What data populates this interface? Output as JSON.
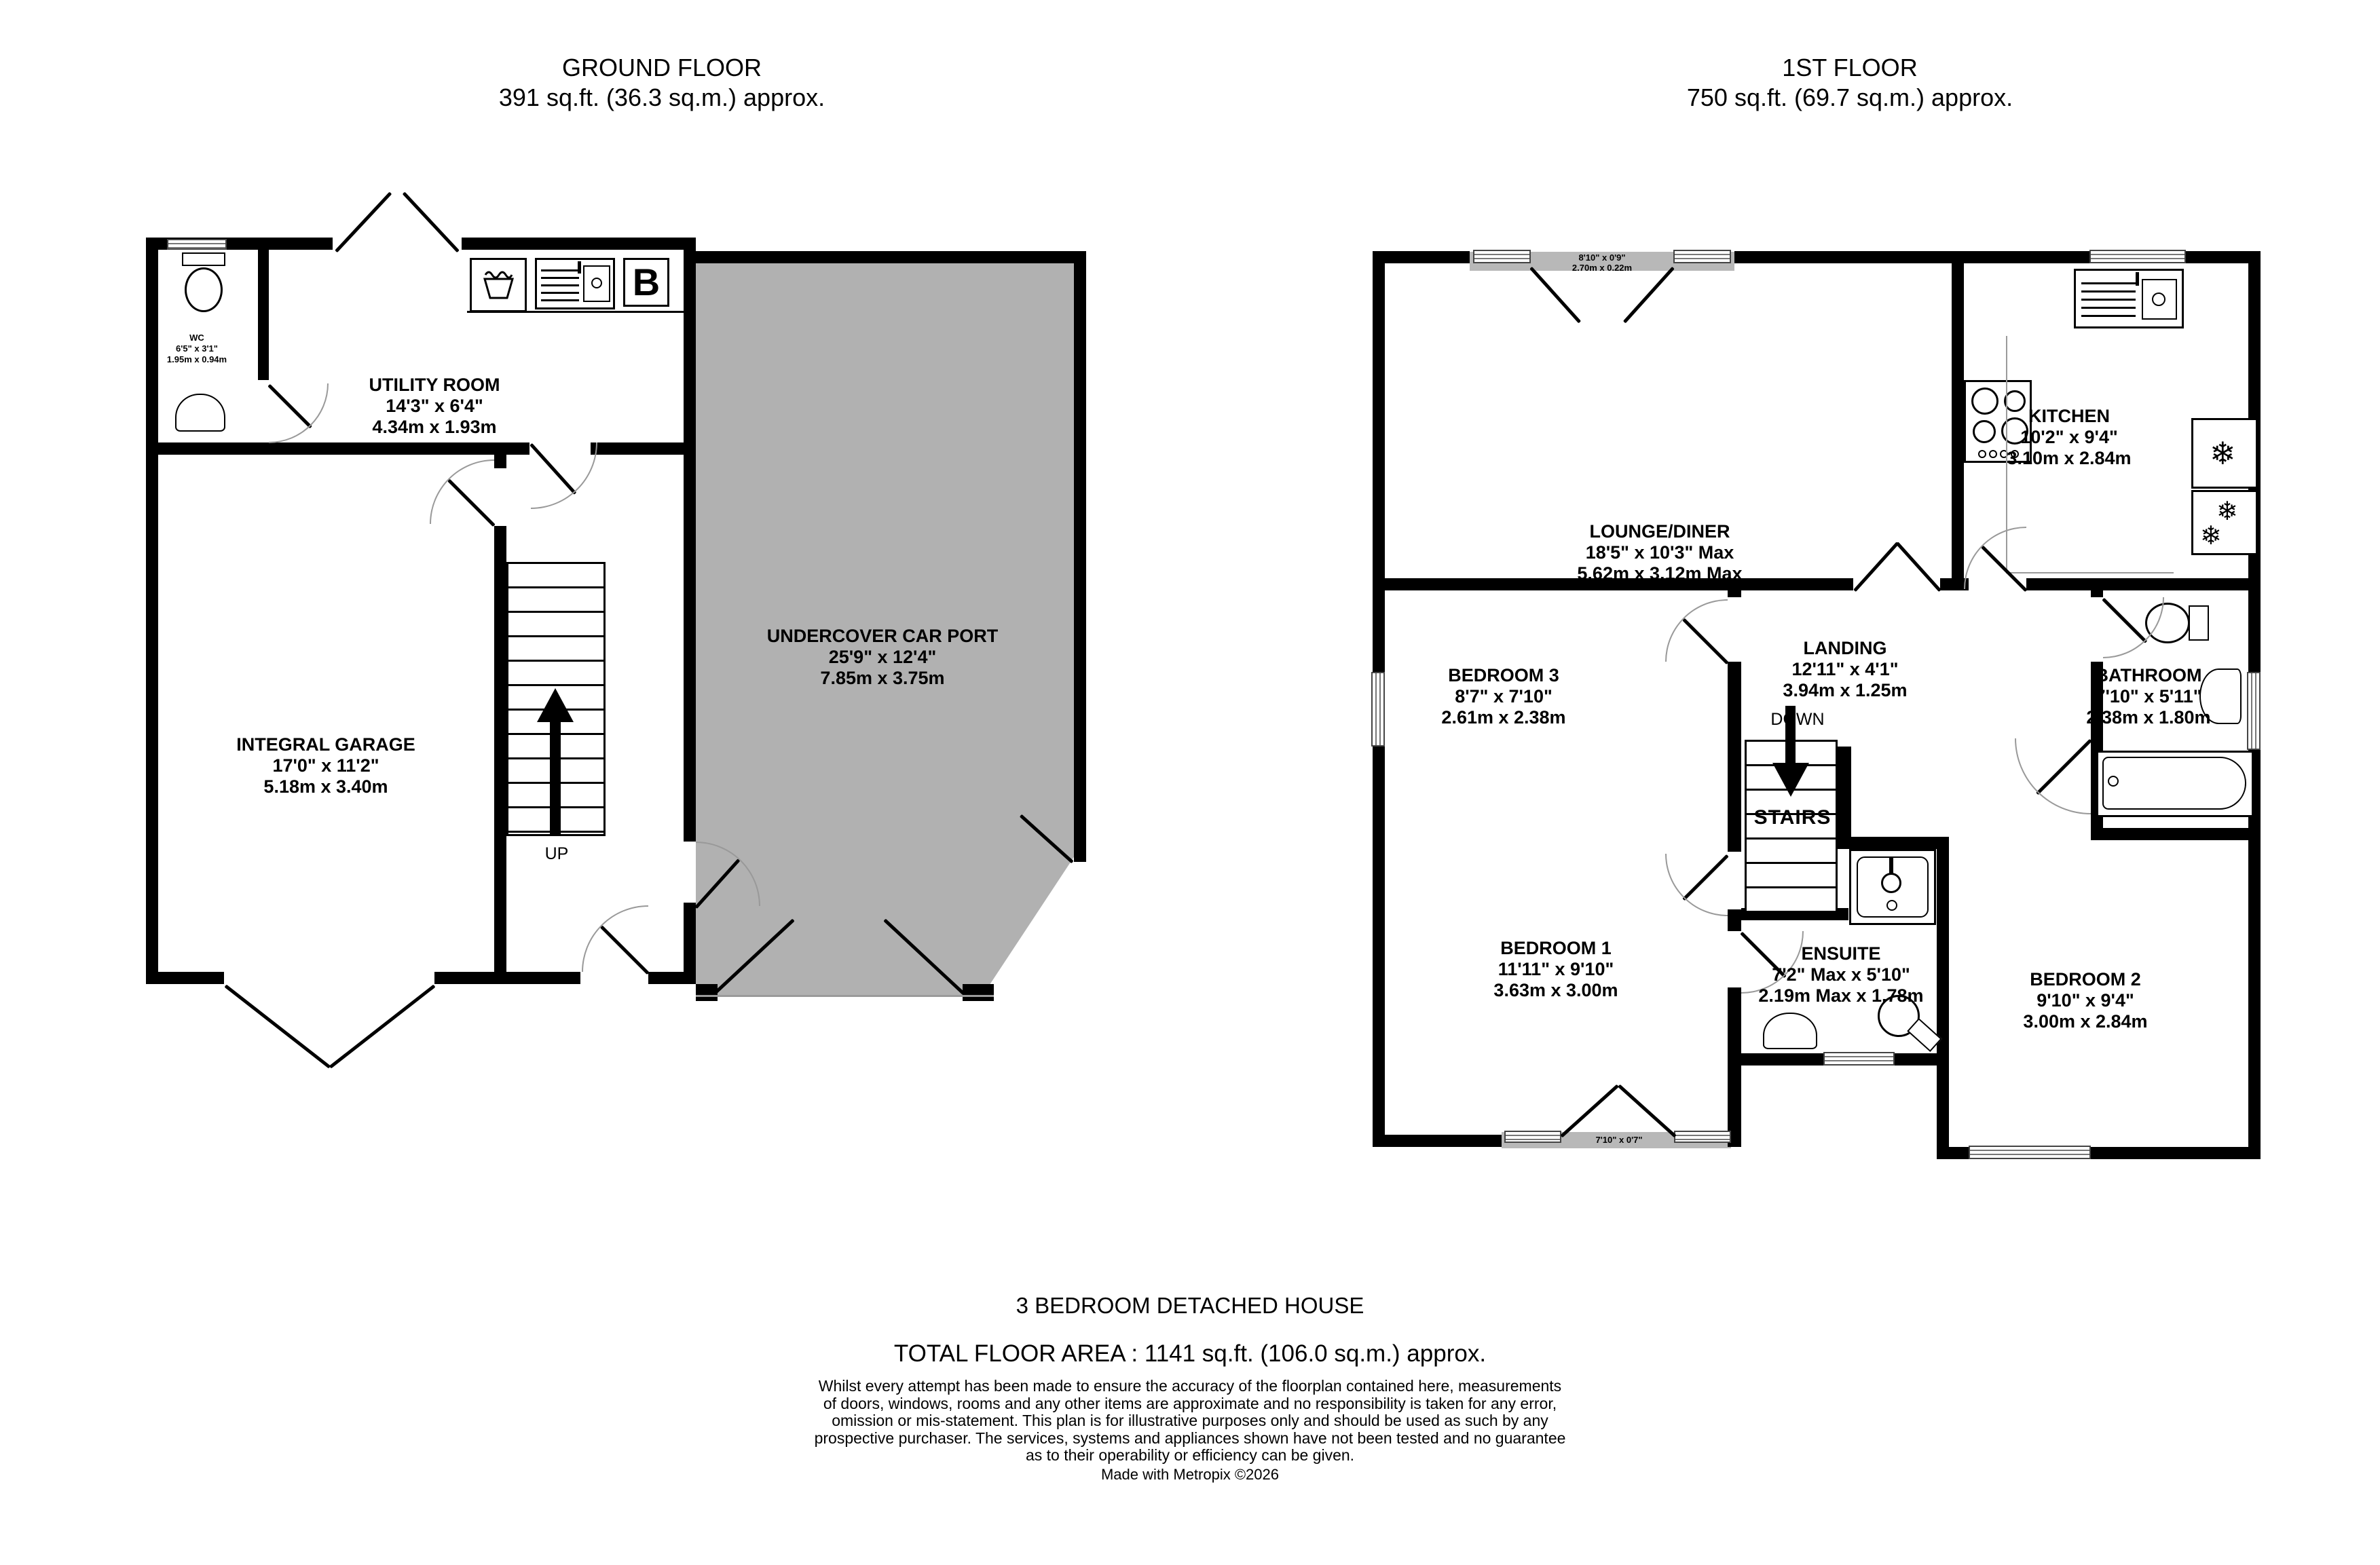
{
  "ground_floor": {
    "title": "GROUND FLOOR",
    "subtitle": "391 sq.ft. (36.3 sq.m.) approx.",
    "rooms": {
      "wc": {
        "name": "WC",
        "imperial": "6'5\"  x 3'1\"",
        "metric": "1.95m  x 0.94m"
      },
      "utility": {
        "name": "UTILITY ROOM",
        "imperial": "14'3\"  x 6'4\"",
        "metric": "4.34m  x 1.93m"
      },
      "garage": {
        "name": "INTEGRAL GARAGE",
        "imperial": "17'0\"  x 11'2\"",
        "metric": "5.18m  x 3.40m"
      },
      "carport": {
        "name": "UNDERCOVER CAR PORT",
        "imperial": "25'9\"  x 12'4\"",
        "metric": "7.85m  x 3.75m"
      }
    },
    "labels": {
      "up": "UP",
      "boiler": "B"
    }
  },
  "first_floor": {
    "title": "1ST FLOOR",
    "subtitle": "750 sq.ft. (69.7 sq.m.) approx.",
    "rooms": {
      "lounge": {
        "name": "LOUNGE/DINER",
        "imperial": "18'5\"  x 10'3\" Max",
        "metric": "5.62m  x 3.12m Max"
      },
      "kitchen": {
        "name": "KITCHEN",
        "imperial": "10'2\"  x 9'4\"",
        "metric": "3.10m  x 2.84m"
      },
      "landing": {
        "name": "LANDING",
        "imperial": "12'11\"  x 4'1\"",
        "metric": "3.94m  x 1.25m"
      },
      "bedroom3": {
        "name": "BEDROOM 3",
        "imperial": "8'7\"  x 7'10\"",
        "metric": "2.61m  x 2.38m"
      },
      "bathroom": {
        "name": "BATHROOM",
        "imperial": "7'10\"  x 5'11\"",
        "metric": "2.38m  x 1.80m"
      },
      "bedroom1": {
        "name": "BEDROOM 1",
        "imperial": "11'11\"  x 9'10\"",
        "metric": "3.63m  x 3.00m"
      },
      "ensuite": {
        "name": "ENSUITE",
        "imperial": "7'2\" Max x 5'10\"",
        "metric": "2.19m Max x 1.78m"
      },
      "bedroom2": {
        "name": "BEDROOM 2",
        "imperial": "9'10\"  x 9'4\"",
        "metric": "3.00m  x 2.84m"
      }
    },
    "balconies": {
      "lounge": {
        "imperial": "8'10\"  x 0'9\"",
        "metric": "2.70m  x 0.22m"
      },
      "bedroom1": {
        "imperial": "7'10\"  x 0'7\""
      }
    },
    "labels": {
      "down": "DOWN",
      "stairs": "STAIRS"
    }
  },
  "footer": {
    "property_type": "3 BEDROOM DETACHED HOUSE",
    "total_area": "TOTAL FLOOR AREA : 1141 sq.ft. (106.0 sq.m.) approx.",
    "disclaimer": "Whilst every attempt has been made to ensure the accuracy of the floorplan contained here, measurements\nof doors, windows, rooms and any other items are approximate and no responsibility is taken for any error,\nomission or mis-statement. This plan is for illustrative purposes only and should be used as such by any\nprospective purchaser. The services, systems and appliances shown have not been tested and no guarantee\nas to their operability or efficiency can be given.",
    "credit": "Made with Metropix ©2026"
  },
  "colors": {
    "wall": "#000000",
    "carport_fill": "#b1b1b1",
    "balcony_fill": "#b8b8b8"
  }
}
